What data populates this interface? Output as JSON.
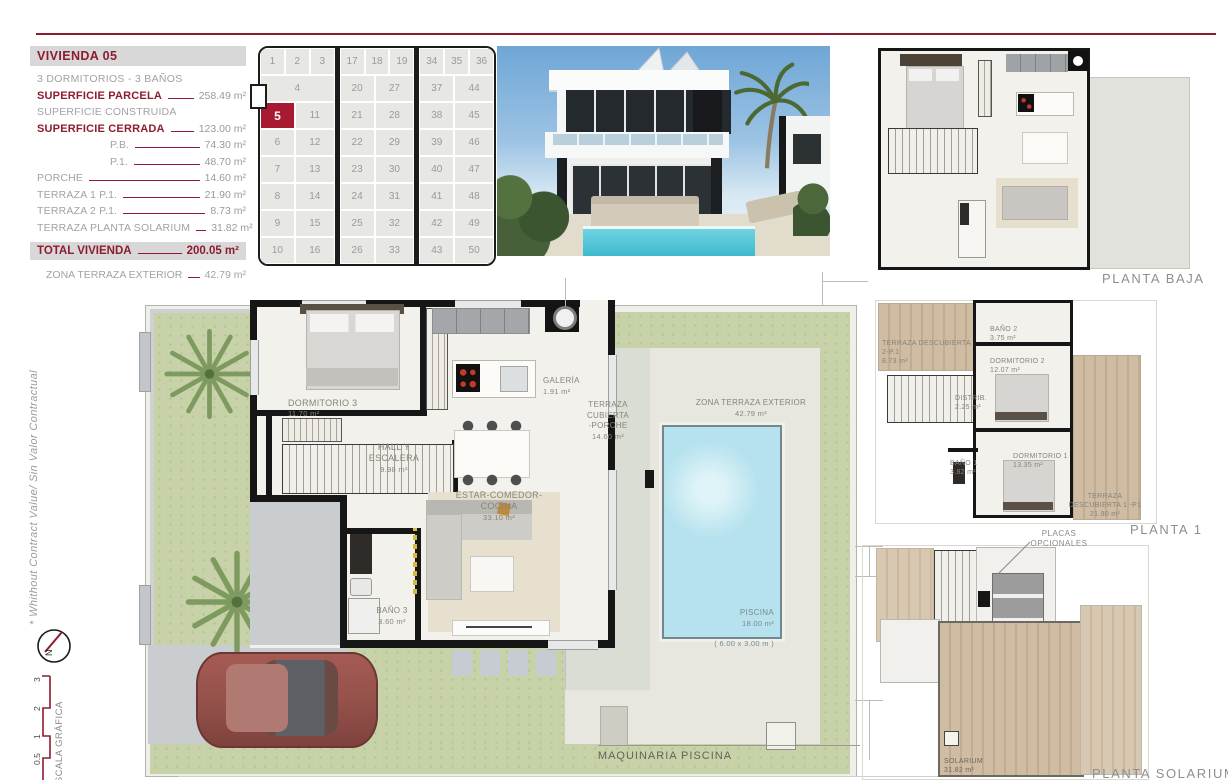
{
  "theme": {
    "accent": "#8e1b30",
    "selected_plot": "#a81a32",
    "pool_blue": "#b5e2ee",
    "garden_green": "#c7d2a9",
    "wood_tan": "#cdb9a1"
  },
  "spec_panel": {
    "title": "VIVIENDA 05",
    "subtitle": "3 DORMITORIOS - 3 BAÑOS",
    "rows": [
      {
        "label": "SUPERFICIE PARCELA",
        "value": "258.49 m²",
        "style": "bold"
      },
      {
        "label": "SUPERFICIE CONSTRUIDA",
        "value": "",
        "style": "plain"
      },
      {
        "label": "SUPERFICIE CERRADA",
        "value": "123.00 m²",
        "style": "bold"
      },
      {
        "label": "P.B.",
        "value": "74.30 m²",
        "style": "indent"
      },
      {
        "label": "P.1.",
        "value": "48.70 m²",
        "style": "indent"
      },
      {
        "label": "PORCHE",
        "value": "14.60 m²",
        "style": "plain"
      },
      {
        "label": "TERRAZA 1 P.1.",
        "value": "21.90 m²",
        "style": "plain"
      },
      {
        "label": "TERRAZA 2 P.1.",
        "value": "8.73 m²",
        "style": "plain"
      },
      {
        "label": "TERRAZA PLANTA SOLARIUM",
        "value": "31.82 m²",
        "style": "plain"
      }
    ],
    "total": {
      "label": "TOTAL VIVIENDA",
      "value": "200.05 m²"
    },
    "footer": {
      "label": "ZONA TERRAZA EXTERIOR",
      "value": "42.79 m²"
    }
  },
  "plot_grid": {
    "selected": "5",
    "blocks": [
      {
        "top": [
          "1",
          "2",
          "3"
        ],
        "rows": [
          [
            "4"
          ],
          [
            "5",
            "11"
          ],
          [
            "6",
            "12"
          ],
          [
            "7",
            "13"
          ],
          [
            "8",
            "14"
          ],
          [
            "9",
            "15"
          ],
          [
            "10",
            "16"
          ]
        ]
      },
      {
        "top": [
          "17",
          "18",
          "19"
        ],
        "rows": [
          [
            "20",
            "27"
          ],
          [
            "21",
            "28"
          ],
          [
            "22",
            "29"
          ],
          [
            "23",
            "30"
          ],
          [
            "24",
            "31"
          ],
          [
            "25",
            "32"
          ],
          [
            "26",
            "33"
          ]
        ]
      },
      {
        "top": [
          "34",
          "35",
          "36"
        ],
        "rows": [
          [
            "37",
            "44"
          ],
          [
            "38",
            "45"
          ],
          [
            "39",
            "46"
          ],
          [
            "40",
            "47"
          ],
          [
            "41",
            "48"
          ],
          [
            "42",
            "49"
          ],
          [
            "43",
            "50"
          ]
        ]
      }
    ]
  },
  "site_plan": {
    "rooms": {
      "dormitorio3": {
        "name": "DORMITORIO 3",
        "area": "11.70 m²"
      },
      "hall": {
        "name": "HALL Y ESCALERA",
        "area": "9.98 m²"
      },
      "estar": {
        "name": "ESTAR-COMEDOR-COCINA",
        "area": "33.10 m²"
      },
      "galeria": {
        "name": "GALERÍA",
        "area": "1.91 m²"
      },
      "bano3": {
        "name": "BAÑO 3",
        "area": "3.60 m²"
      },
      "porche": {
        "name": "TERRAZA CUBIERTA\n-PORCHE",
        "area": "14.60 m²"
      },
      "zona_terraza": {
        "name": "ZONA TERRAZA EXTERIOR",
        "area": "42.79 m²"
      },
      "piscina": {
        "name": "PISCINA",
        "area": "18.00 m²",
        "dims": "( 6.00 x 3.00 m )"
      }
    },
    "maquinaria_label": "MAQUINARIA PISCINA"
  },
  "plans": {
    "baja": {
      "label": "PLANTA BAJA"
    },
    "p1": {
      "label": "PLANTA 1",
      "rooms": {
        "terraza2": {
          "name": "TERRAZA DESCUBIERTA 2-P.1",
          "area": "8.73 m²"
        },
        "bano2": {
          "name": "BAÑO 2",
          "area": "3.75 m²"
        },
        "dorm2": {
          "name": "DORMITORIO 2",
          "area": "12.07 m²"
        },
        "distrib": {
          "name": "DISTRIB.",
          "area": "2.25 m²"
        },
        "bano1": {
          "name": "BAÑO 1",
          "area": "3.82 m²"
        },
        "dorm1": {
          "name": "DORMITORIO 1",
          "area": "13.35 m²"
        },
        "terraza1": {
          "name": "TERRAZA\nDESCUBIERTA 1 -P1",
          "area": "21.90 m²"
        }
      }
    },
    "solarium": {
      "label": "PLANTA SOLARIUM",
      "placas_label": "PLACAS OPCIONALES",
      "room": {
        "name": "SOLARIUM",
        "area": "31.82 m²"
      }
    }
  },
  "margin": {
    "disclaimer": "* Whithout Contract Value/ Sin Valor Contractual",
    "north_label": "N",
    "scale_label": "ESCALA GRÁFICA",
    "scale_ticks": [
      "3",
      "2",
      "1",
      "0.5"
    ]
  }
}
